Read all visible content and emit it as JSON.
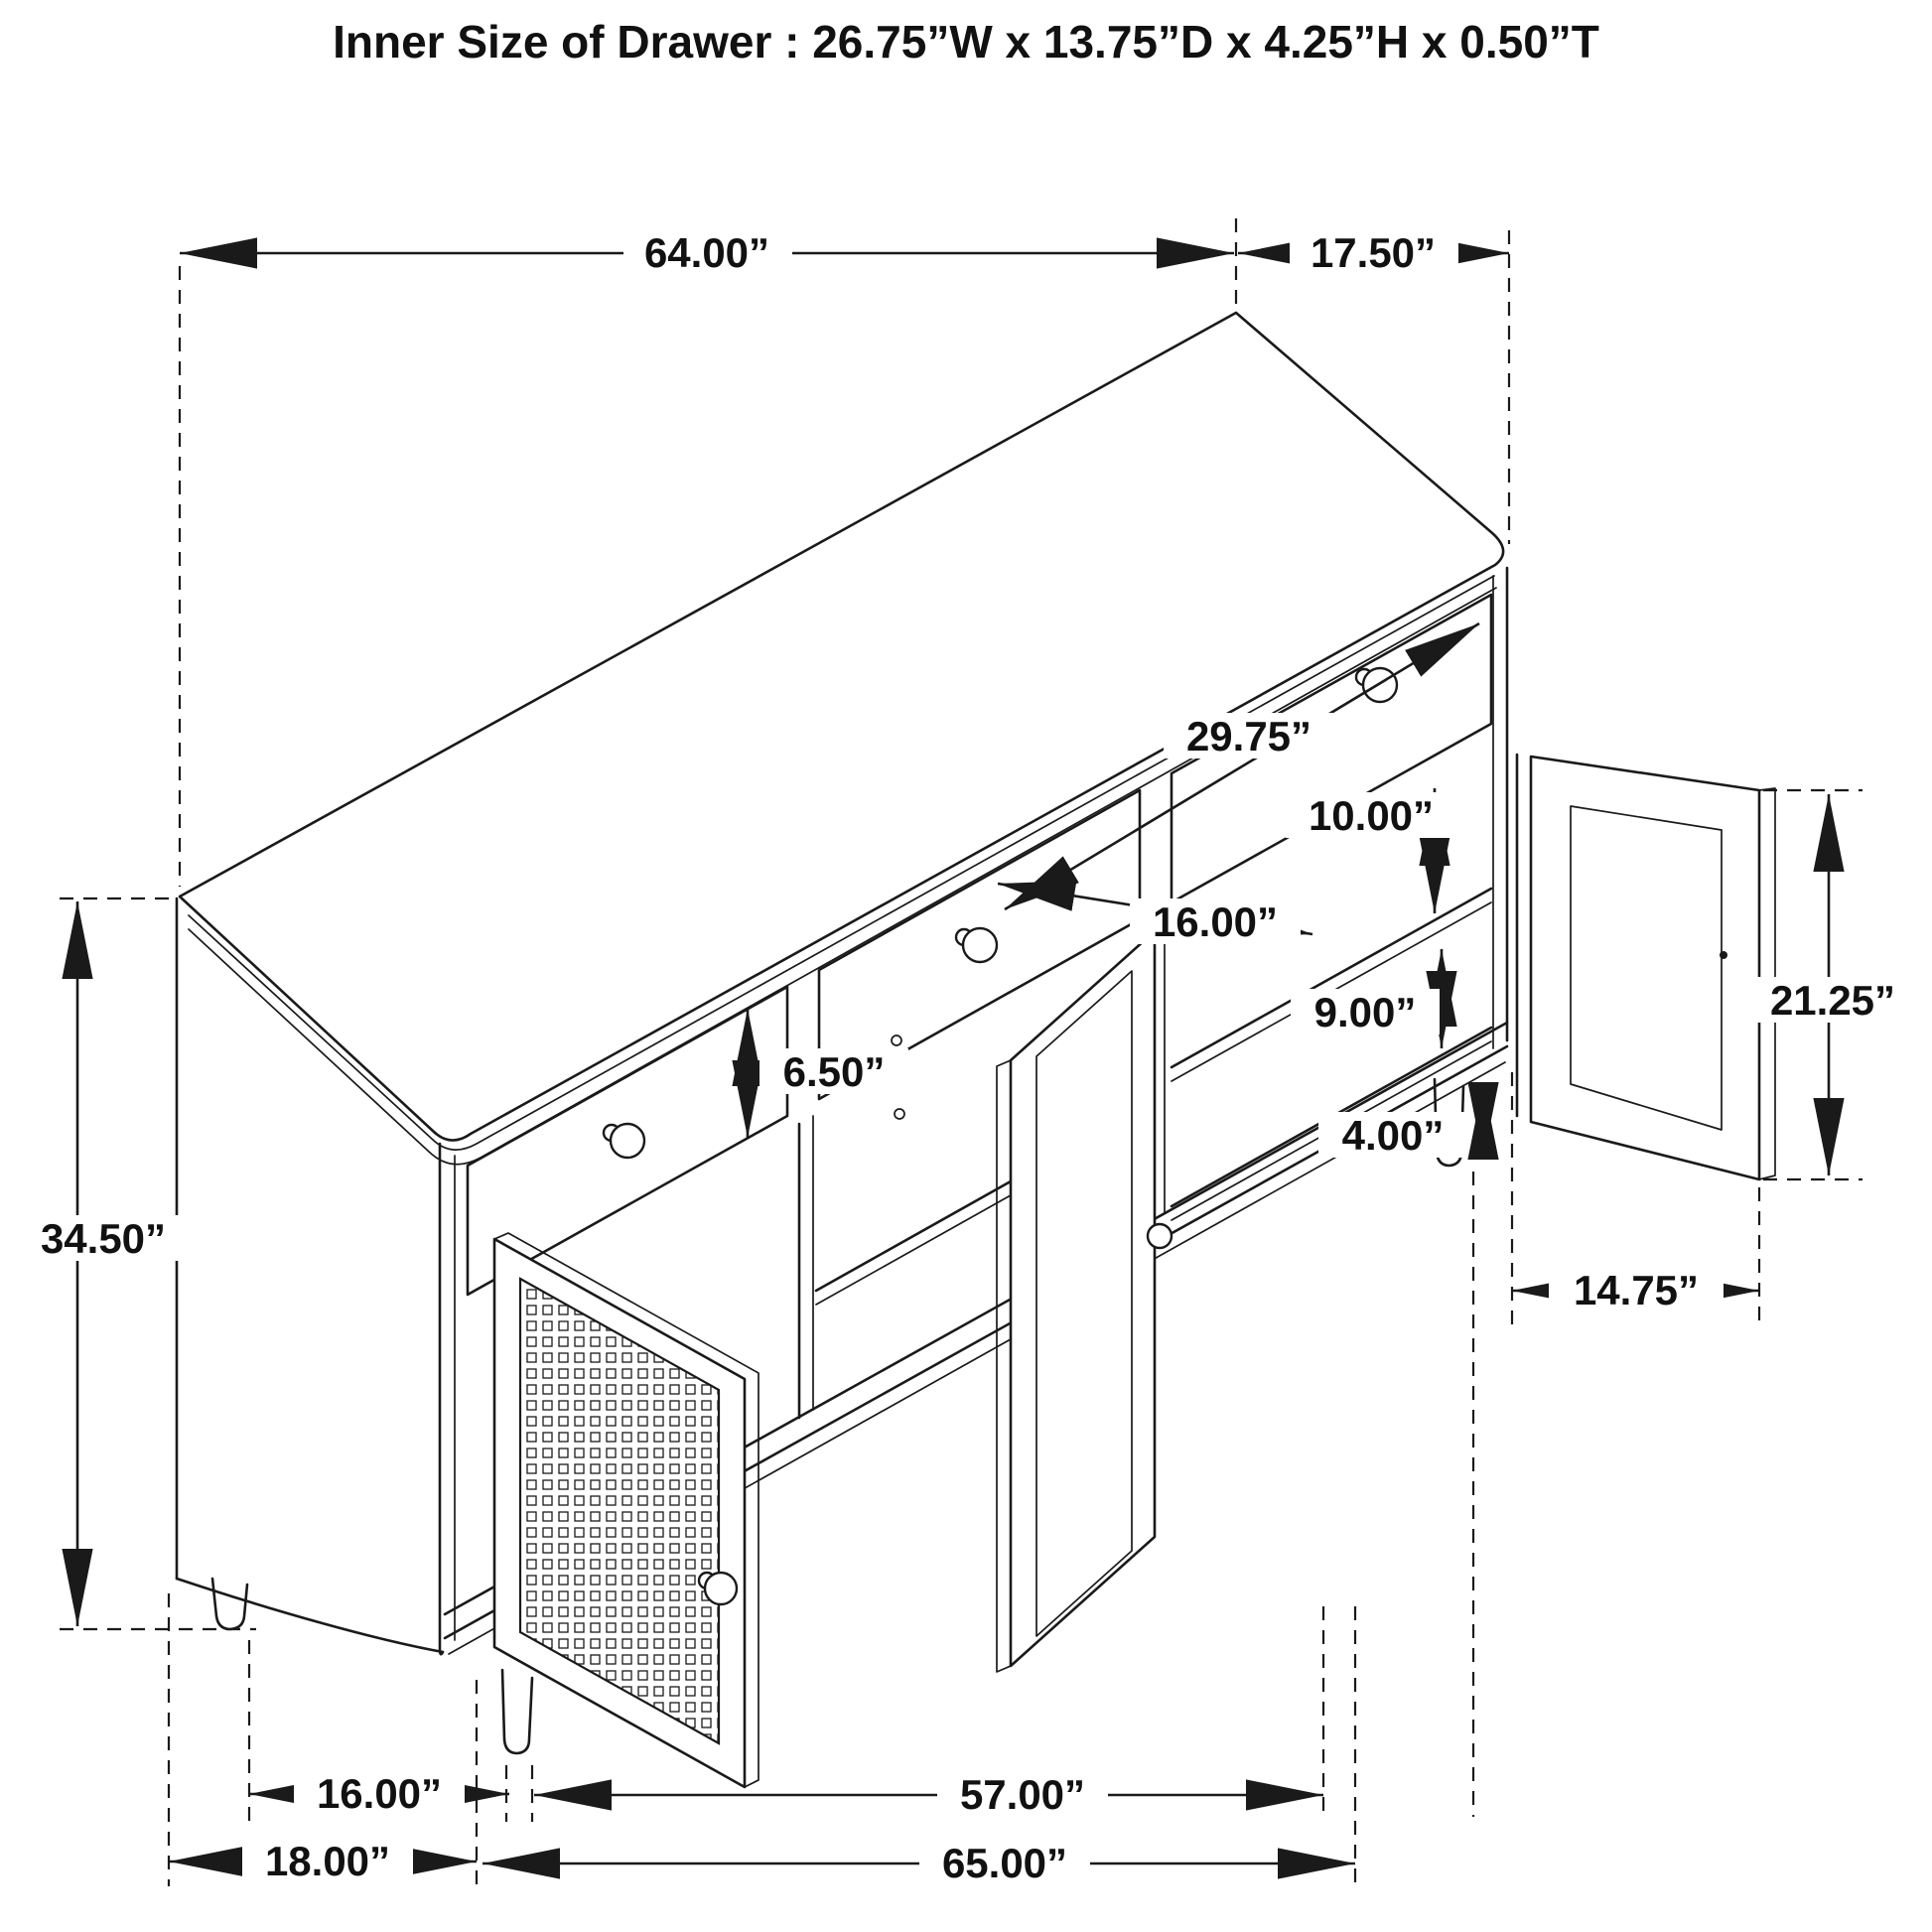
{
  "title": "Inner Size of Drawer  : 26.75”W x 13.75”D x 4.25”H x 0.50”T",
  "drawing": "isometric-sideboard-line-drawing",
  "dimensions": {
    "top_width": "64.00”",
    "top_depth": "17.50”",
    "overall_height": "34.50”",
    "drawer_opening_width": "29.75”",
    "upper_shelf_gap": "10.00”",
    "middle_opening_width": "16.00”",
    "lower_shelf_gap": "9.00”",
    "drawer_front_height": "6.50”",
    "leg_height": "4.00”",
    "door_height": "21.25”",
    "door_width": "14.75”",
    "floor_leg_spacing_depth": "16.00”",
    "floor_depth_overall": "18.00”",
    "floor_width_between_legs": "57.00”",
    "floor_width_overall": "65.00”"
  },
  "colors": {
    "line": "#1a1a1a",
    "background": "#ffffff"
  }
}
